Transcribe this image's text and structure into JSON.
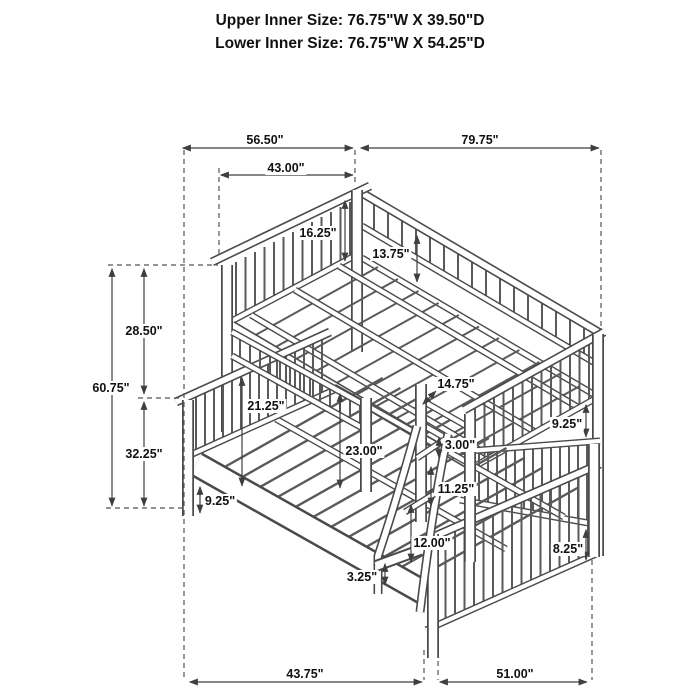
{
  "title": {
    "line1": "Upper Inner Size: 76.75\"W X 39.50\"D",
    "line2": "Lower Inner Size: 76.75\"W X 54.25\"D"
  },
  "drawing": {
    "name": "bunk-bed-isometric-line-drawing",
    "description": "Twin over full bunk bed with slatted headboards, guard rails and front ladder"
  },
  "colors": {
    "background": "#ffffff",
    "line_work": "#4a4a4a",
    "dimension_lines": "#3f3f3f",
    "text": "#111111"
  },
  "dimensions": {
    "overall_depth": {
      "label": "56.50\""
    },
    "overall_length": {
      "label": "79.75\""
    },
    "upper_bed_depth": {
      "label": "43.00\""
    },
    "headboard_above_deck": {
      "label": "16.25\""
    },
    "upper_guardrail_height": {
      "label": "13.75\""
    },
    "upper_section_height": {
      "label": "28.50\""
    },
    "overall_height": {
      "label": "60.75\""
    },
    "lower_section_height": {
      "label": "32.25\""
    },
    "under_bunk_clearance": {
      "label": "21.25\""
    },
    "ladder_opening_width": {
      "label": "14.75\""
    },
    "deck_to_rail_height": {
      "label": "23.00\""
    },
    "top_step_gap": {
      "label": "3.00\""
    },
    "right_rail_gap": {
      "label": "9.25\""
    },
    "mid_step_gap": {
      "label": "11.25\""
    },
    "left_rail_height": {
      "label": "9.25\""
    },
    "bottom_step_gap": {
      "label": "12.00\""
    },
    "right_rail_height": {
      "label": "8.25\""
    },
    "step_to_floor": {
      "label": "3.25\""
    },
    "floor_depth_left": {
      "label": "43.75\""
    },
    "floor_length_right": {
      "label": "51.00\""
    }
  }
}
